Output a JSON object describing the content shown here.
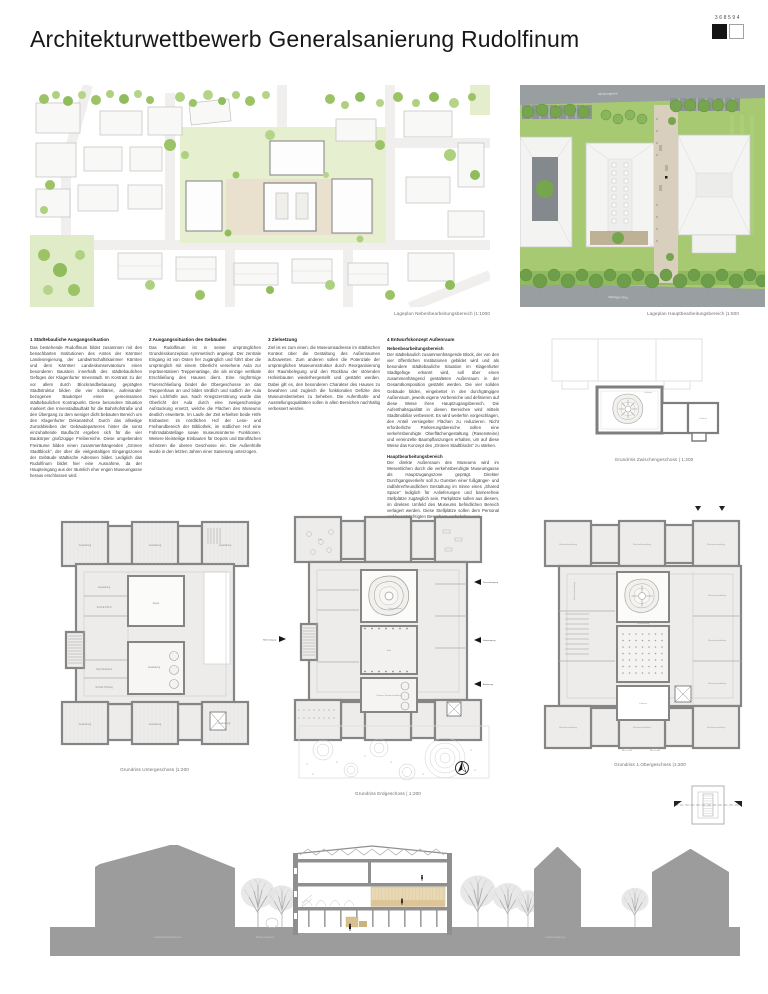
{
  "header": {
    "title": "Architekturwettbewerb Generalsanierung Rudolfinum",
    "entry_number": "368594"
  },
  "siteplans": {
    "left_caption": "Lageplan Nebenbearbeitungsbereich |1:1000",
    "right_caption": "Lageplan Hauptbearbeitungsbereich |1:500",
    "street_top": "Museumgasse",
    "street_bottom": "Viktringer Ring"
  },
  "columns": [
    {
      "heading": "1 Städtebauliche Ausgangssituation",
      "paragraphs": [
        "Das bestehende Rudolfinum bildet zusammen mit den benachbarten Institutionen des Amtes der Kärntner Landesregierung, der Landwirtschaftskammer Kärnten und dem Kärntner Landeskonservatorium einen besonderen Baustein innerhalb des städtebaulichen Gefüges der Klagenfurter Innenstadt. Im Kontrast zu der vor allem durch Blockrandbebauung geprägten Stadtstruktur bilden die vier solitären, aufeinander bezogenen Baukörper einen gemeinsamen städtebaulichen Kontrapunkt. Diese besondere Situation markiert den Innenstadtauftakt für die Bahnhofstraße und den Übergang zu dem weniger dicht bebauten Bereich um den Klagenfurter Dekanatshof. Durch das allseitige Zurückbleiben der Gebäudeparterres hinter die sonst einzuhaltende Bauflucht ergeben sich für die vier Baukörper großzügige Freibereiche. Diese umgebenden Freiräume bilden einen zusammenhängenden „Grünen Stadtblock“, der über die vielgestaltigen Eingangszonen der Gebäude städtische Adressen bildet. Lediglich das Rudolfinum bildet hier eine Ausnahme, da der Haupteingang aus der räumlich eher engen Museumgasse heraus erschlossen wird."
      ]
    },
    {
      "heading": "2 Ausgangssituation des Gebäudes",
      "paragraphs": [
        "Das Rudolfinum ist in seiner ursprünglichen Grundrisskonzeption symmetrisch angelegt. Der zentrale Eingang ist von Osten her zugänglich und führt über die ursprünglich mit einem Oberlicht versehene Aula zur repräsentativen Treppenanlage, die als einzige vertikale Erschließung des Hauses dient. Eine ringförmige Flurerschließung bindet die Obergeschosse an das Treppenhaus an und bildet nördlich und südlich der Aula zwei Lichthöfe aus. Nach Kriegszerstörung wurde das Oberlicht der Aula durch eine zweigeschossige Aufstockung ersetzt, welche die Flächen des Museums deutlich erweiterte. Im Laufe der Zeit erhielten beide Höfe Einbauten: im nördlichen Hof der Lese- und Freihandbereich der Bibliothek, im südlichen Hof eine Fahrradabstellage sowie museumsinterne Funktionen. Weitere kleinteilige Einbauten für Depots und Büroflächen schnüren die oberen Geschosse ein. Die Außenhülle wurde in den letzten Jahren einer Sanierung unterzogen."
      ]
    },
    {
      "heading": "3 Zielsetzung",
      "paragraphs": [
        "Ziel ist es zum einen, die Museumsadresse im städtischen Kontext über die Gestaltung des Außenraumes aufzuwerten. Zum anderen sollen die Potenziale der ursprünglichen Museumsstruktur durch Reorganisierung der Raumbelegung und den Rückbau der störenden Hofeinbauten wiederhergestellt und gestärkt werden. Dabei gilt es, den besonderen Charakter des Hauses zu bewahren und zugleich die funktionalen Defizite des Museumsbetriebes zu beheben. Die Aufenthalts- und Ausstellungsqualitäten sollen in allen Bereichen nachhaltig verbessert werden."
      ]
    },
    {
      "heading": "4 Entwurfskonzept Außenraum",
      "subsections": [
        {
          "subheading": "Nebenbearbeitungsbereich",
          "text": "Der städtebaulich zusammenhängende Block, der von den vier öffentlichen Institutionen gebildet wird und als besondere städtebauliche Situation im Klagenfurter Stadtgefüge erkannt wird, soll über einen zusammenhängend gestalteten Außenraum in der Gesamtkomposition gestärkt werden. Die vier soliden Gebäude bilden, eingebettet in den durchgängigen Außenraum, jeweils eigene Vorbereiche und definieren auf diese Weise ihren Hauptzugangsbereich. Die Aufenthaltsqualität in diesen Bereichen wird mittels Stadtmobiliar verbessert. Es wird weiterhin vorgeschlagen, den Anteil versiegelter Flächen zu reduzieren. Nicht erforderliche Parkierungsbereiche sollen eine verkehrsberuhigte Oberflächengestaltung (Rasensteine) und vereinzelte Baumpflanzungen erhalten, um auf diese Weise das Konzept des „Grünen Stadtblocks“ zu stärken."
        },
        {
          "subheading": "Hauptbearbeitungsbereich",
          "text": "Der direkte Außenraum des Museums wird im Wesentlichen durch die verkehrsberuhigte Museumgasse als Hauptzugangszone geprägt. Direkter Durchgangsverkehr soll zu Gunsten einer fußgänger- und radfahrerfreundlichen Gestaltung im Sinne eines „Shared Space“ lediglich für Anlieferungen und barrierefreie Stellplätze zugänglich sein. Parkplätze sollen aus diesem, im direkten Umfeld des Museums befindlichen Bereich verlagert werden. Diese Stellplätze sollen dem Personal und beeinträchtigten Besuchern vorbehalten sein."
        }
      ]
    }
  ],
  "plans": {
    "zwischengeschoss": {
      "caption": "Grundriss Zwischengeschoss | 1:200",
      "label_luftraum": "Luftraum"
    },
    "untergeschoss": {
      "caption": "Grundriss Untergeschoss |1:200",
      "label_ausstellung": "Ausstellung",
      "label_depot": "Depot",
      "label_technik_hkls": "Technik HKLS",
      "label_technik_elektro": "Technik Elektro",
      "label_technik_heizung": "Technik Heizung"
    },
    "erdgeschoss": {
      "caption": "Grundriss Erdgeschoss | 1:200",
      "label_cafe": "Café",
      "label_museumsshop": "Museumsshop",
      "label_aula": "Aula",
      "label_sonderausstellung": "Museum Sonderausstellung",
      "arrow_nebeneingang": "Nebeneingang",
      "arrow_personaleingang": "Personaleingang",
      "arrow_haupteingang": "Haupteingang",
      "arrow_anlieferung": "Anlieferung"
    },
    "obergeschoss": {
      "caption": "Grundriss 1.Obergeschoss |1:200",
      "label_wechselausstellung": "Wechselausstellung",
      "label_veranstaltung": "Veranstaltung",
      "label_luftraum": "Luftraum"
    }
  },
  "section_drawing": {
    "labels": [
      "Landwirtschaftskammer",
      "Museumsgasse",
      "Landesregierung"
    ]
  },
  "colors": {
    "lawn_green": "#a6c972",
    "tree_green": "#76a54e",
    "light_green": "#c8df9f",
    "plaza_beige": "#e9e1cd",
    "path_beige": "#d8d0bc",
    "wall_gray": "#858585",
    "mass_gray": "#9c9c9c",
    "street_gray": "#999ea1",
    "wood": "#e8d9b4"
  }
}
